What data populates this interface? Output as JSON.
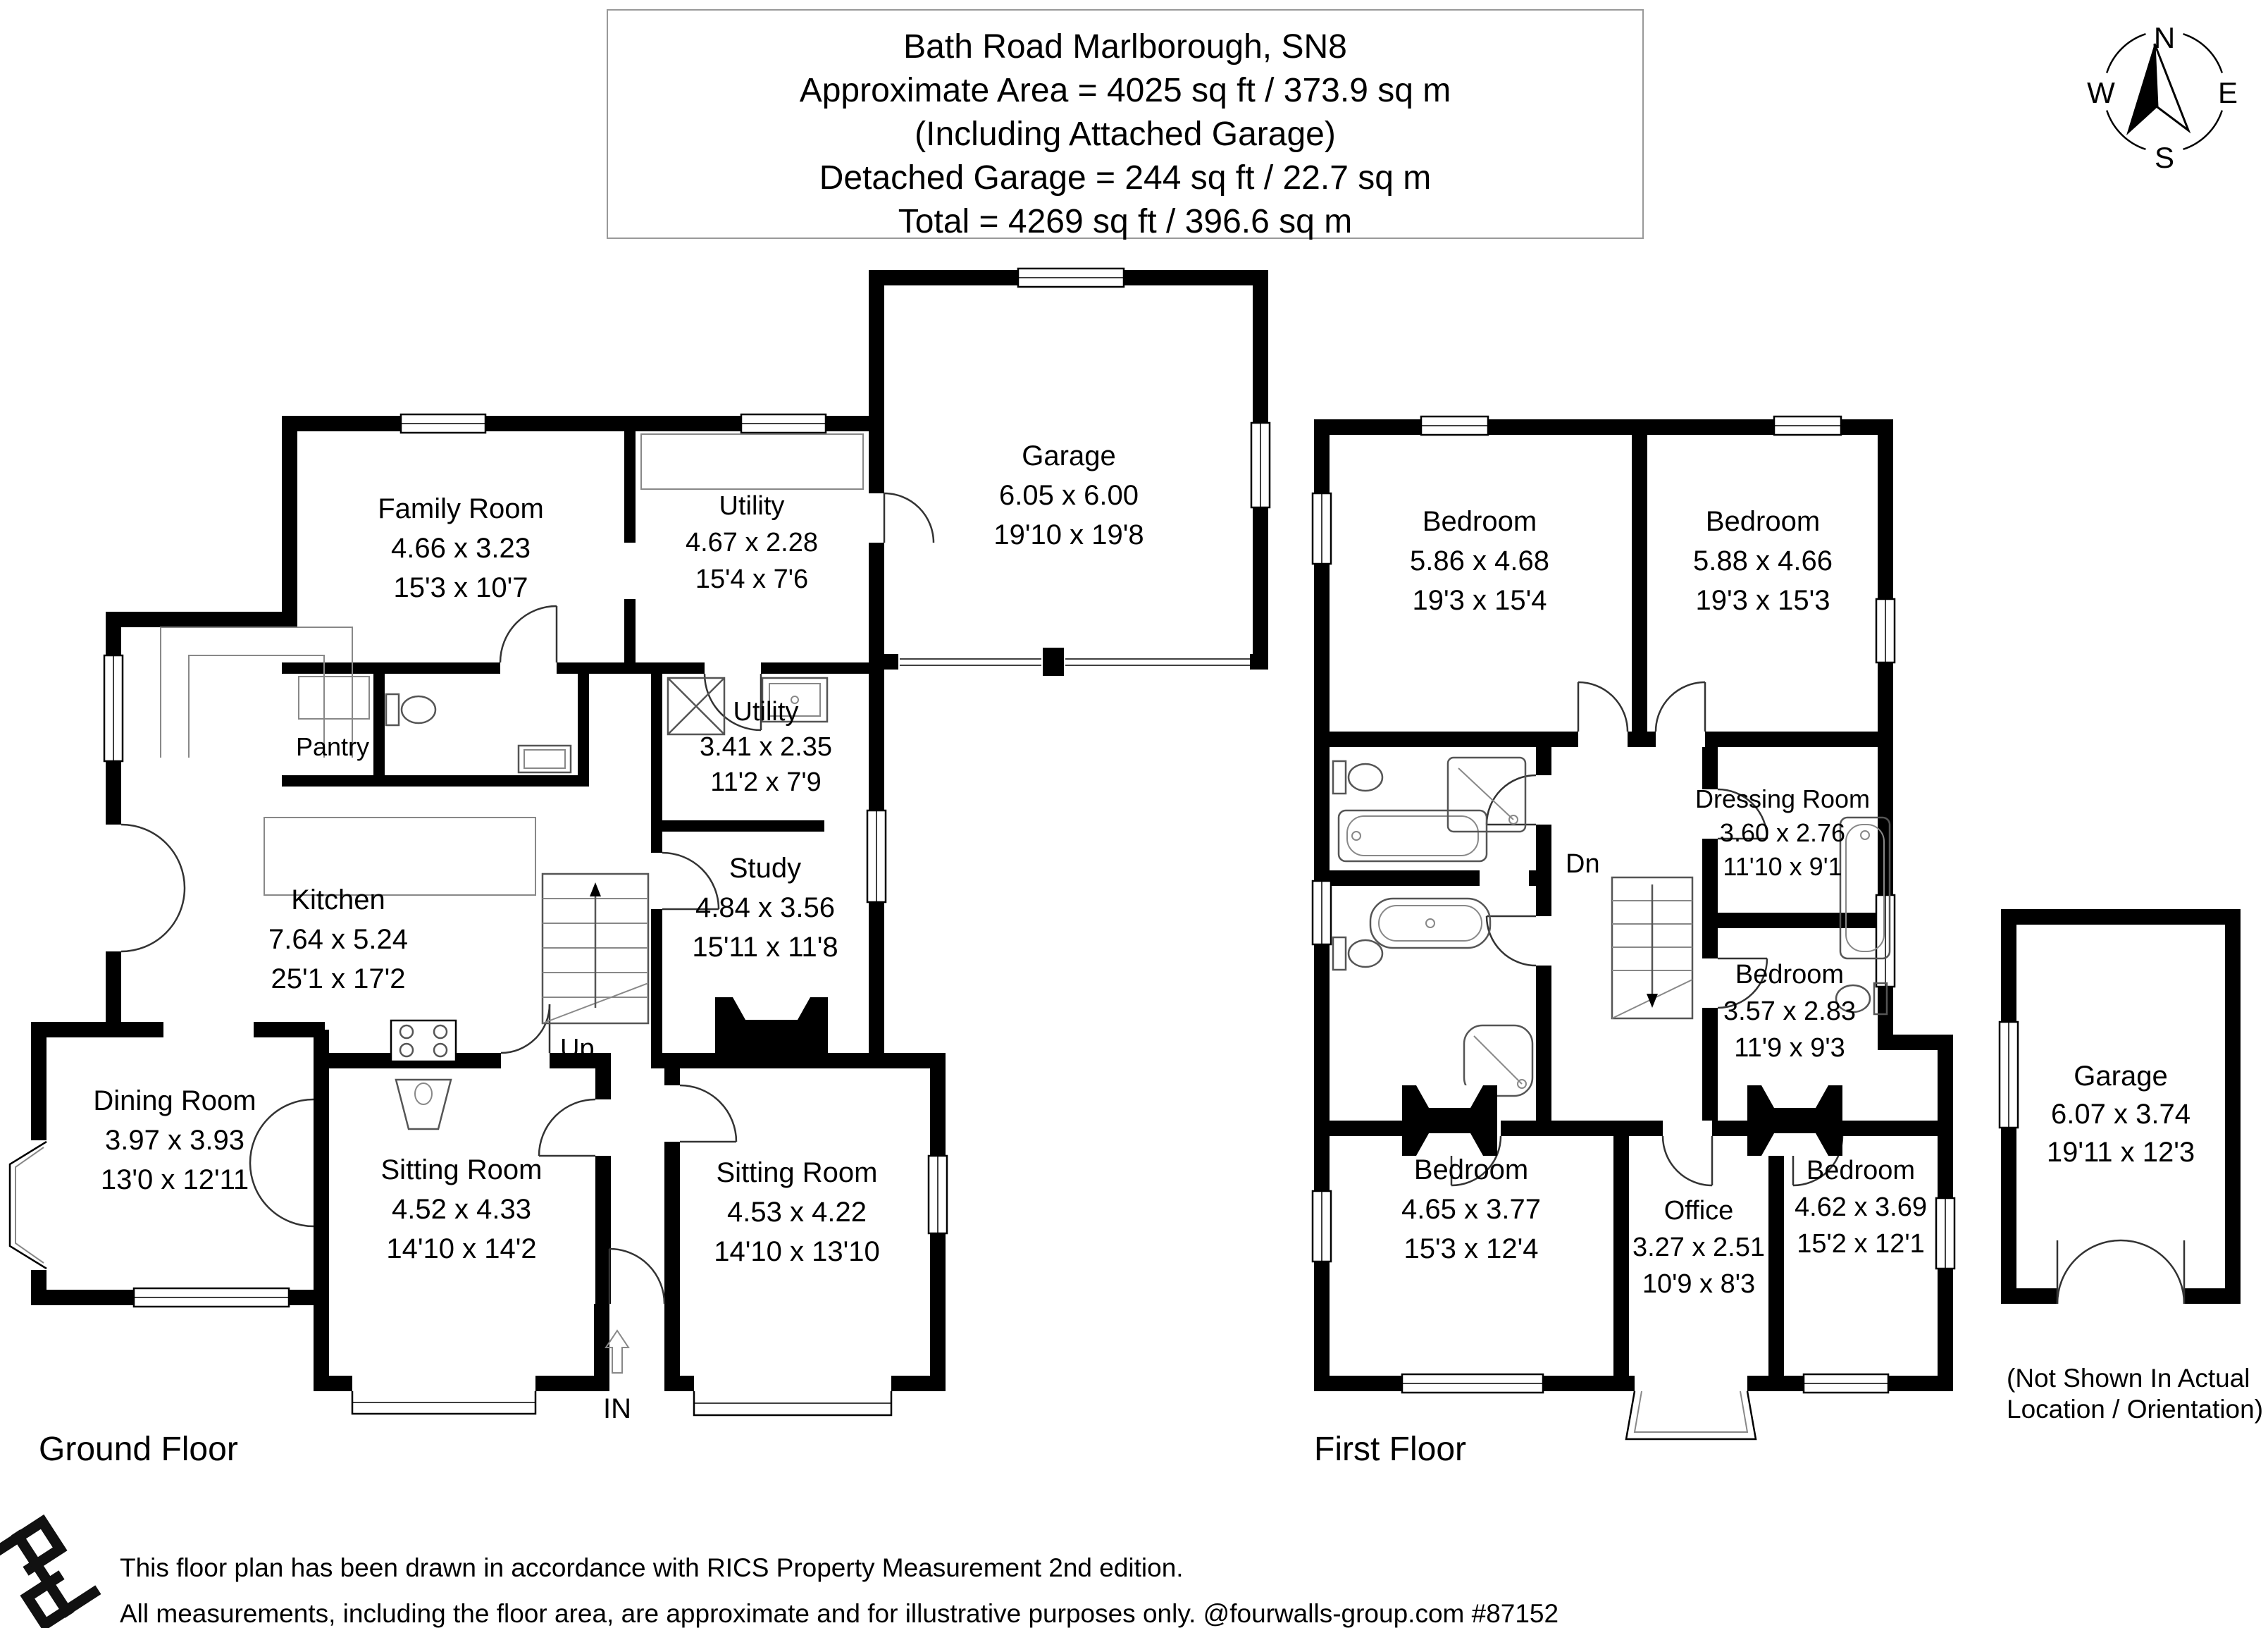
{
  "title": {
    "line1": "Bath Road Marlborough, SN8",
    "line2": "Approximate Area = 4025 sq ft / 373.9 sq m",
    "line3": "(Including Attached Garage)",
    "line4": "Detached Garage = 244 sq ft / 22.7 sq m",
    "line5": "Total = 4269 sq ft / 396.6 sq m"
  },
  "compass": {
    "n": "N",
    "e": "E",
    "s": "S",
    "w": "W"
  },
  "ground": {
    "label": "Ground Floor",
    "up": "Up",
    "entrance": "IN",
    "rooms": {
      "family": {
        "name": "Family Room",
        "m": "4.66 x 3.23",
        "i": "15'3 x 10'7"
      },
      "utility1": {
        "name": "Utility",
        "m": "4.67 x 2.28",
        "i": "15'4 x 7'6"
      },
      "utility2": {
        "name": "Utility",
        "m": "3.41 x 2.35",
        "i": "11'2 x 7'9"
      },
      "garage": {
        "name": "Garage",
        "m": "6.05 x 6.00",
        "i": "19'10 x 19'8"
      },
      "pantry": {
        "name": "Pantry"
      },
      "kitchen": {
        "name": "Kitchen",
        "m": "7.64 x 5.24",
        "i": "25'1 x 17'2"
      },
      "study": {
        "name": "Study",
        "m": "4.84 x 3.56",
        "i": "15'11 x 11'8"
      },
      "dining": {
        "name": "Dining Room",
        "m": "3.97 x 3.93",
        "i": "13'0 x 12'11"
      },
      "sitting1": {
        "name": "Sitting Room",
        "m": "4.52 x 4.33",
        "i": "14'10 x 14'2"
      },
      "sitting2": {
        "name": "Sitting Room",
        "m": "4.53 x 4.22",
        "i": "14'10 x 13'10"
      }
    }
  },
  "first": {
    "label": "First Floor",
    "dn": "Dn",
    "rooms": {
      "bedroom1": {
        "name": "Bedroom",
        "m": "5.86 x 4.68",
        "i": "19'3 x 15'4"
      },
      "bedroom2": {
        "name": "Bedroom",
        "m": "5.88 x 4.66",
        "i": "19'3 x 15'3"
      },
      "dressing": {
        "name": "Dressing Room",
        "m": "3.60 x 2.76",
        "i": "11'10 x 9'1"
      },
      "bedroom3": {
        "name": "Bedroom",
        "m": "3.57 x 2.83",
        "i": "11'9 x 9'3"
      },
      "bedroom4": {
        "name": "Bedroom",
        "m": "4.65 x 3.77",
        "i": "15'3 x 12'4"
      },
      "office": {
        "name": "Office",
        "m": "3.27 x 2.51",
        "i": "10'9 x 8'3"
      },
      "bedroom5": {
        "name": "Bedroom",
        "m": "4.62 x 3.69",
        "i": "15'2 x 12'1"
      }
    }
  },
  "detached": {
    "name": "Garage",
    "m": "6.07 x 3.74",
    "i": "19'11 x 12'3",
    "note1": "(Not Shown In Actual",
    "note2": "Location / Orientation)"
  },
  "footer": {
    "line1": "This floor plan has been drawn in accordance with RICS Property Measurement 2nd edition.",
    "line2": "All measurements, including the floor area, are approximate and for illustrative purposes only. @fourwalls-group.com #87152"
  }
}
